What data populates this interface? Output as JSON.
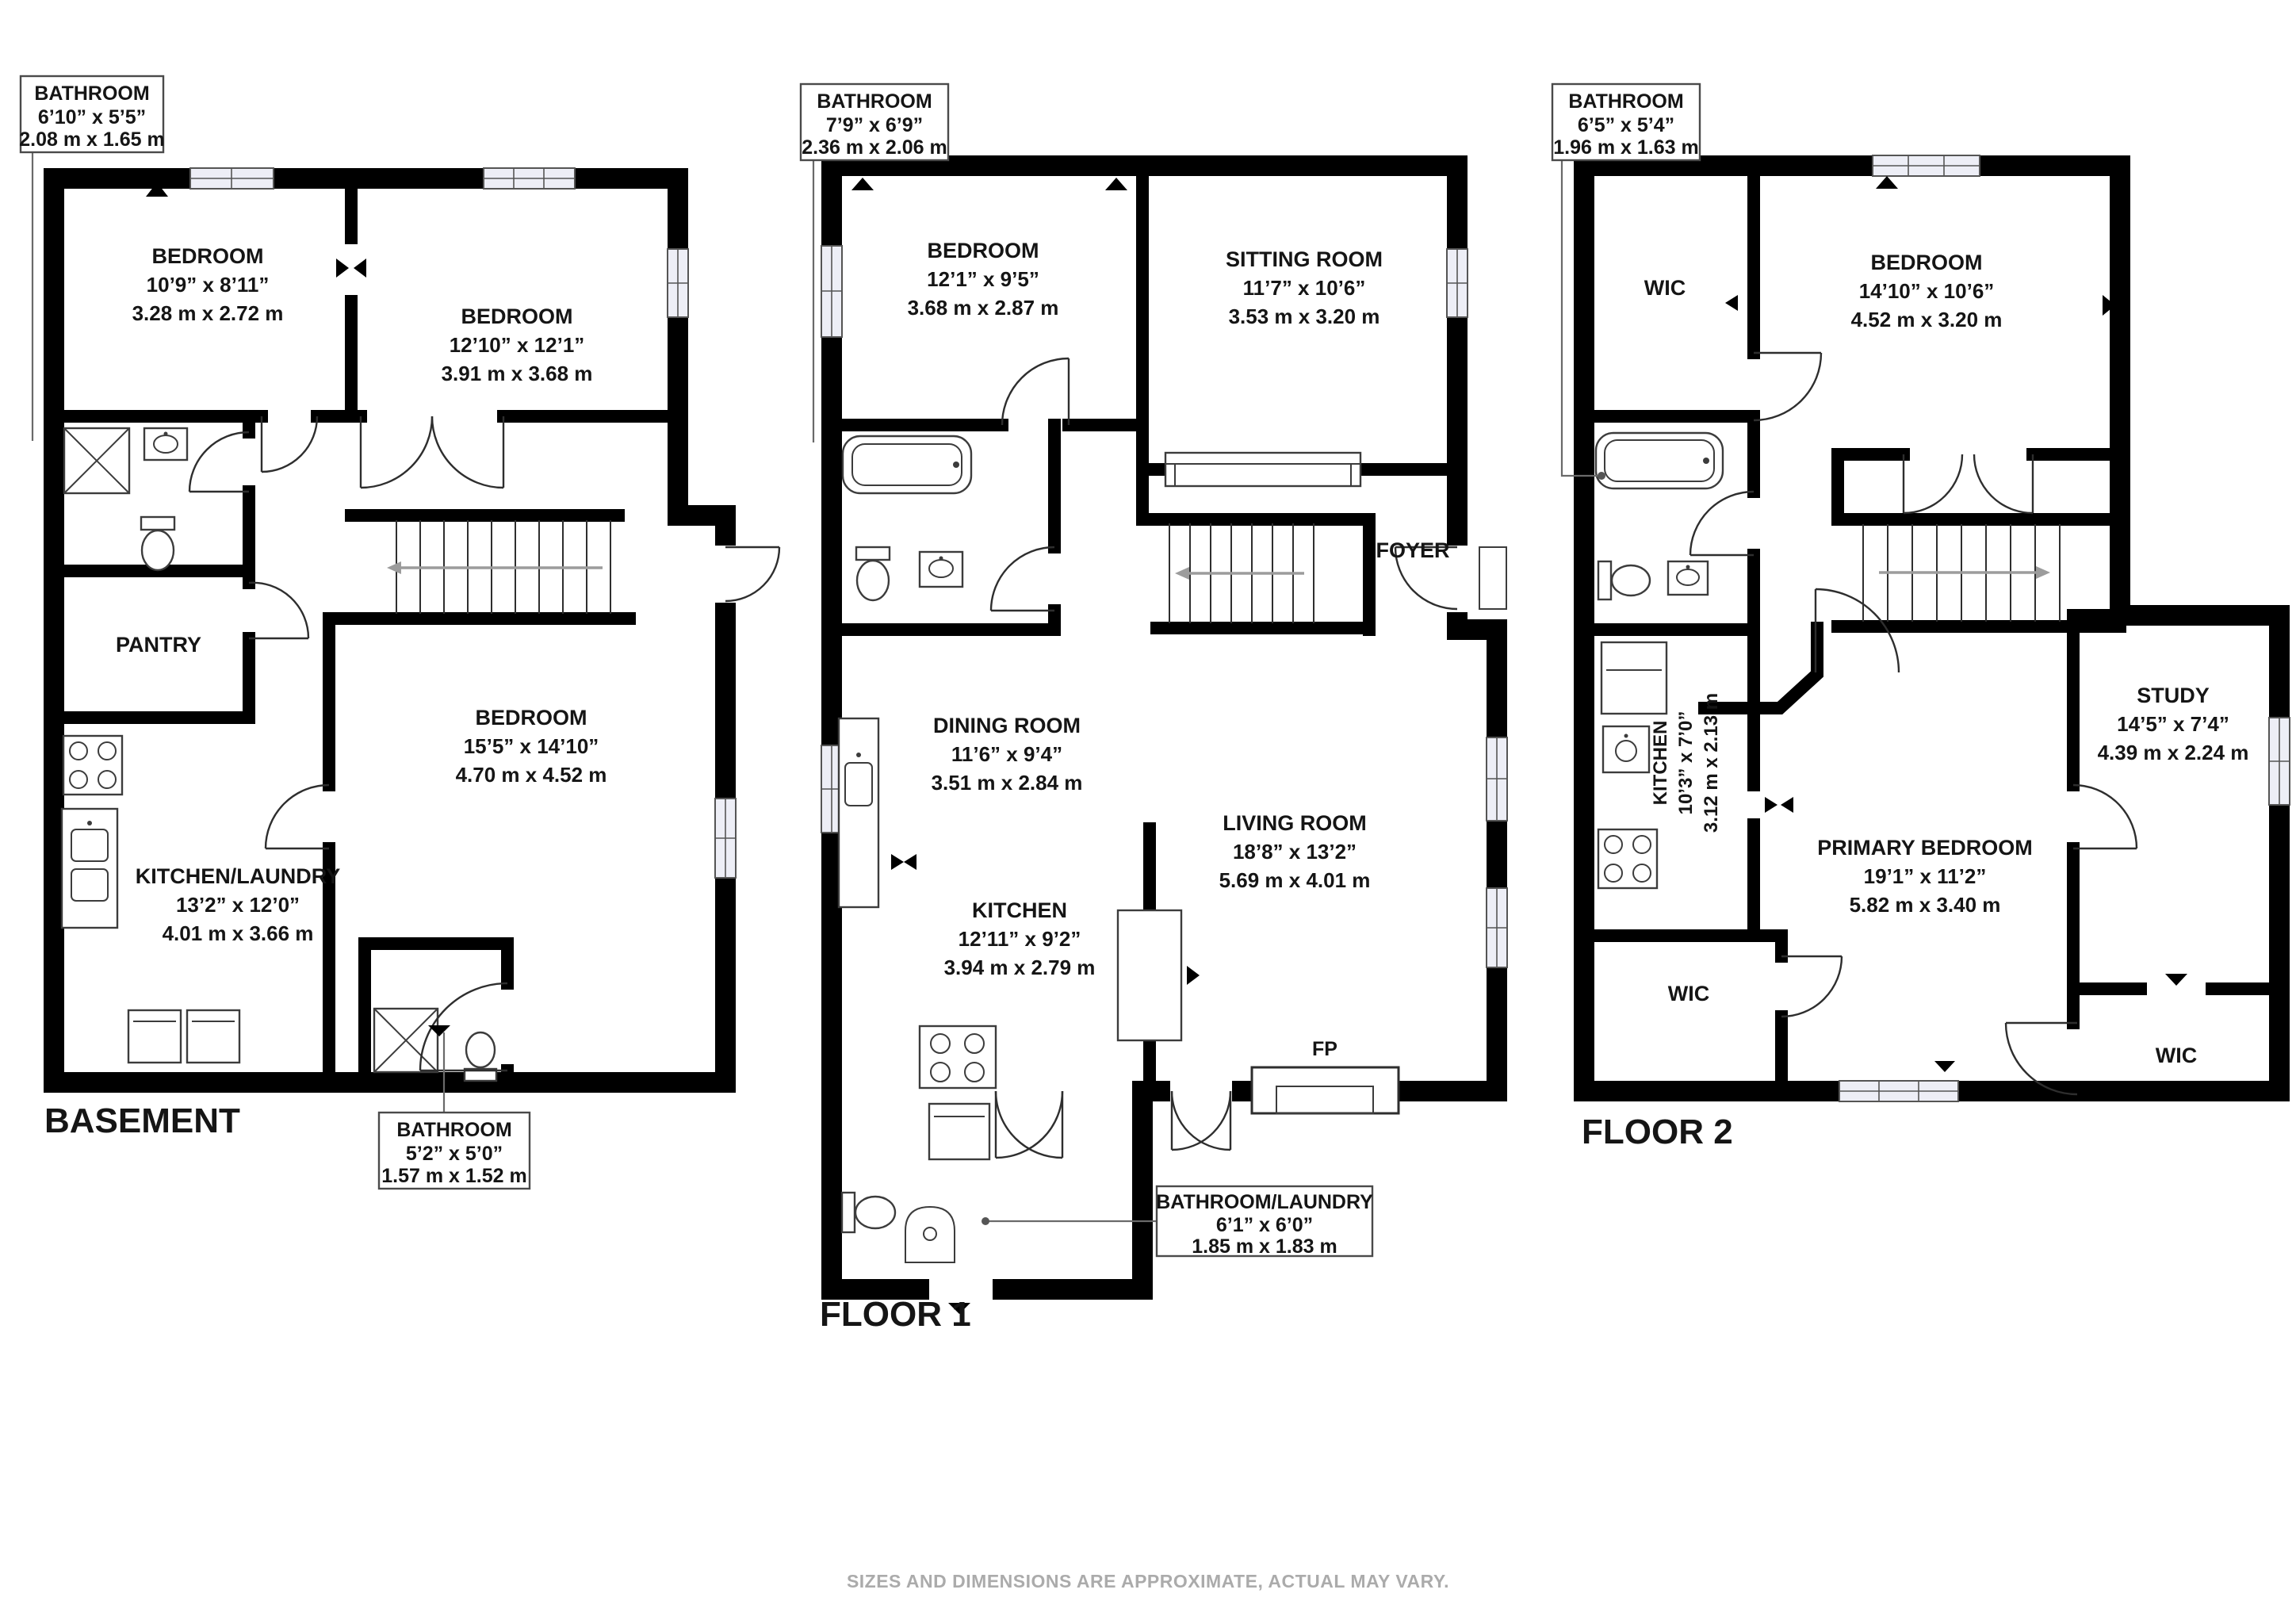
{
  "footer": {
    "disclaimer": "SIZES AND DIMENSIONS ARE APPROXIMATE, ACTUAL MAY VARY."
  },
  "colors": {
    "wall": "#000000",
    "window_fill": "#edeef6",
    "leader": "#6a6a6a",
    "stair_arrow": "#9c9c9c",
    "disclaimer_text": "#ababab"
  },
  "floors": [
    {
      "label": "BASEMENT",
      "rooms": [
        {
          "name": "BEDROOM",
          "imperial": "10’9” x 8’11”",
          "metric": "3.28 m x 2.72 m"
        },
        {
          "name": "BEDROOM",
          "imperial": "12’10” x 12’1”",
          "metric": "3.91 m x 3.68 m"
        },
        {
          "name": "PANTRY"
        },
        {
          "name": "BEDROOM",
          "imperial": "15’5” x 14’10”",
          "metric": "4.70 m x 4.52 m"
        },
        {
          "name": "KITCHEN/LAUNDRY",
          "imperial": "13’2” x 12’0”",
          "metric": "4.01 m x 3.66 m"
        }
      ],
      "callouts": [
        {
          "title": "BATHROOM",
          "imperial": "6’10” x 5’5”",
          "metric": "2.08 m x 1.65 m"
        },
        {
          "title": "BATHROOM",
          "imperial": "5’2” x 5’0”",
          "metric": "1.57 m x 1.52 m"
        }
      ]
    },
    {
      "label": "FLOOR 1",
      "rooms": [
        {
          "name": "BEDROOM",
          "imperial": "12’1” x 9’5”",
          "metric": "3.68 m x 2.87 m"
        },
        {
          "name": "SITTING ROOM",
          "imperial": "11’7” x 10’6”",
          "metric": "3.53 m x 3.20 m"
        },
        {
          "name": "FOYER"
        },
        {
          "name": "DINING ROOM",
          "imperial": "11’6” x 9’4”",
          "metric": "3.51 m x 2.84 m"
        },
        {
          "name": "LIVING ROOM",
          "imperial": "18’8” x 13’2”",
          "metric": "5.69 m x 4.01 m"
        },
        {
          "name": "KITCHEN",
          "imperial": "12’11” x 9’2”",
          "metric": "3.94 m x 2.79 m"
        },
        {
          "name": "FP"
        }
      ],
      "callouts": [
        {
          "title": "BATHROOM",
          "imperial": "7’9” x 6’9”",
          "metric": "2.36 m x 2.06 m"
        },
        {
          "title": "BATHROOM/LAUNDRY",
          "imperial": "6’1” x 6’0”",
          "metric": "1.85 m x 1.83 m"
        }
      ]
    },
    {
      "label": "FLOOR 2",
      "rooms": [
        {
          "name": "WIC"
        },
        {
          "name": "BEDROOM",
          "imperial": "14’10” x 10’6”",
          "metric": "4.52 m x 3.20 m"
        },
        {
          "name": "KITCHEN",
          "imperial": "10’3” x 7’0”",
          "metric": "3.12 m x 2.13 m"
        },
        {
          "name": "STUDY",
          "imperial": "14’5” x 7’4”",
          "metric": "4.39 m x 2.24 m"
        },
        {
          "name": "PRIMARY BEDROOM",
          "imperial": "19’1” x 11’2”",
          "metric": "5.82 m x 3.40 m"
        },
        {
          "name": "WIC"
        },
        {
          "name": "WIC"
        }
      ],
      "callouts": [
        {
          "title": "BATHROOM",
          "imperial": "6’5” x 5’4”",
          "metric": "1.96 m x 1.63 m"
        }
      ]
    }
  ]
}
